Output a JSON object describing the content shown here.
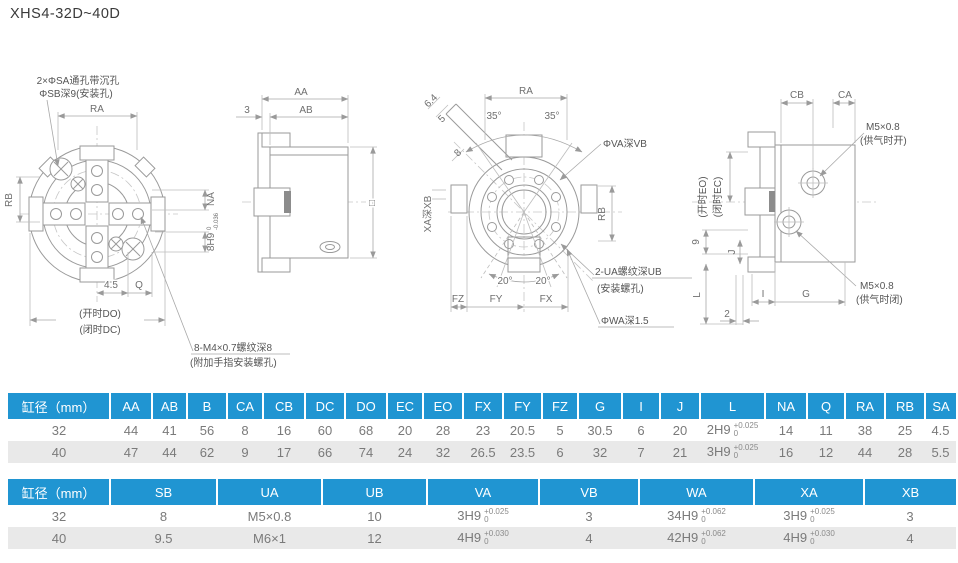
{
  "page": {
    "title": "XHS4-32D~40D"
  },
  "colors": {
    "header_blue": "#2095d2",
    "row_alt": "#e9e9e9",
    "line_gray": "#9a9a9a"
  },
  "drawings": {
    "front": {
      "callout_mount_1": "2×ΦSA通孔带沉孔",
      "callout_mount_2": "ΦSB深9(安装孔)",
      "ra": "RA",
      "rb": "RB",
      "na": "NA",
      "slot": "8H9",
      "slot_sup": "0",
      "slot_sub": "-0.036",
      "d45": "4.5",
      "q": "Q",
      "do_open": "(开时DO)",
      "dc_closed": "(闭时DC)",
      "callout_finger_1": "8-M4×0.7螺纹深8",
      "callout_finger_2": "(附加手指安装螺孔)"
    },
    "side": {
      "aa": "AA",
      "ab": "AB",
      "d3": "3",
      "square": "□"
    },
    "rear": {
      "ra": "RA",
      "a35l": "35°",
      "a35r": "35°",
      "d64": "6.4",
      "d5": "5",
      "d8": "8",
      "xa": "XA深XB",
      "va": "ΦVA深VB",
      "rb": "RB",
      "a20l": "20°",
      "a20r": "20°",
      "fz": "FZ",
      "fy": "FY",
      "fx": "FX",
      "callout_ua_1": "2-UA螺纹深UB",
      "callout_ua_2": "(安装螺孔)",
      "wa": "ΦWA深1.5"
    },
    "port": {
      "cb": "CB",
      "ca": "CA",
      "m5_open_1": "M5×0.8",
      "m5_open_2": "(供气时开)",
      "eo": "(开时EO)",
      "ec": "(闭时EC)",
      "d9": "9",
      "j": "J",
      "l": "L",
      "d2": "2",
      "i": "I",
      "g": "G",
      "m5_close_1": "M5×0.8",
      "m5_close_2": "(供气时闭)"
    }
  },
  "table1": {
    "headers": [
      "缸径（mm）",
      "AA",
      "AB",
      "B",
      "CA",
      "CB",
      "DC",
      "DO",
      "EC",
      "EO",
      "FX",
      "FY",
      "FZ",
      "G",
      "I",
      "J",
      "L",
      "NA",
      "Q",
      "RA",
      "RB",
      "SA"
    ],
    "rows": [
      [
        "32",
        "44",
        "41",
        "56",
        "8",
        "16",
        "60",
        "68",
        "20",
        "28",
        "23",
        "20.5",
        "5",
        "30.5",
        "6",
        "20",
        {
          "m": "2H9",
          "sup": "+0.025",
          "sub": "0"
        },
        "14",
        "11",
        "38",
        "25",
        "4.5"
      ],
      [
        "40",
        "47",
        "44",
        "62",
        "9",
        "17",
        "66",
        "74",
        "24",
        "32",
        "26.5",
        "23.5",
        "6",
        "32",
        "7",
        "21",
        {
          "m": "3H9",
          "sup": "+0.025",
          "sub": "0"
        },
        "16",
        "12",
        "44",
        "28",
        "5.5"
      ]
    ]
  },
  "table2": {
    "headers": [
      "缸径（mm）",
      "SB",
      "UA",
      "UB",
      "VA",
      "VB",
      "WA",
      "XA",
      "XB"
    ],
    "rows": [
      [
        "32",
        "8",
        "M5×0.8",
        "10",
        {
          "m": "3H9",
          "sup": "+0.025",
          "sub": "0"
        },
        "3",
        {
          "m": "34H9",
          "sup": "+0.062",
          "sub": "0"
        },
        {
          "m": "3H9",
          "sup": "+0.025",
          "sub": "0"
        },
        "3"
      ],
      [
        "40",
        "9.5",
        "M6×1",
        "12",
        {
          "m": "4H9",
          "sup": "+0.030",
          "sub": "0"
        },
        "4",
        {
          "m": "42H9",
          "sup": "+0.062",
          "sub": "0"
        },
        {
          "m": "4H9",
          "sup": "+0.030",
          "sub": "0"
        },
        "4"
      ]
    ]
  }
}
